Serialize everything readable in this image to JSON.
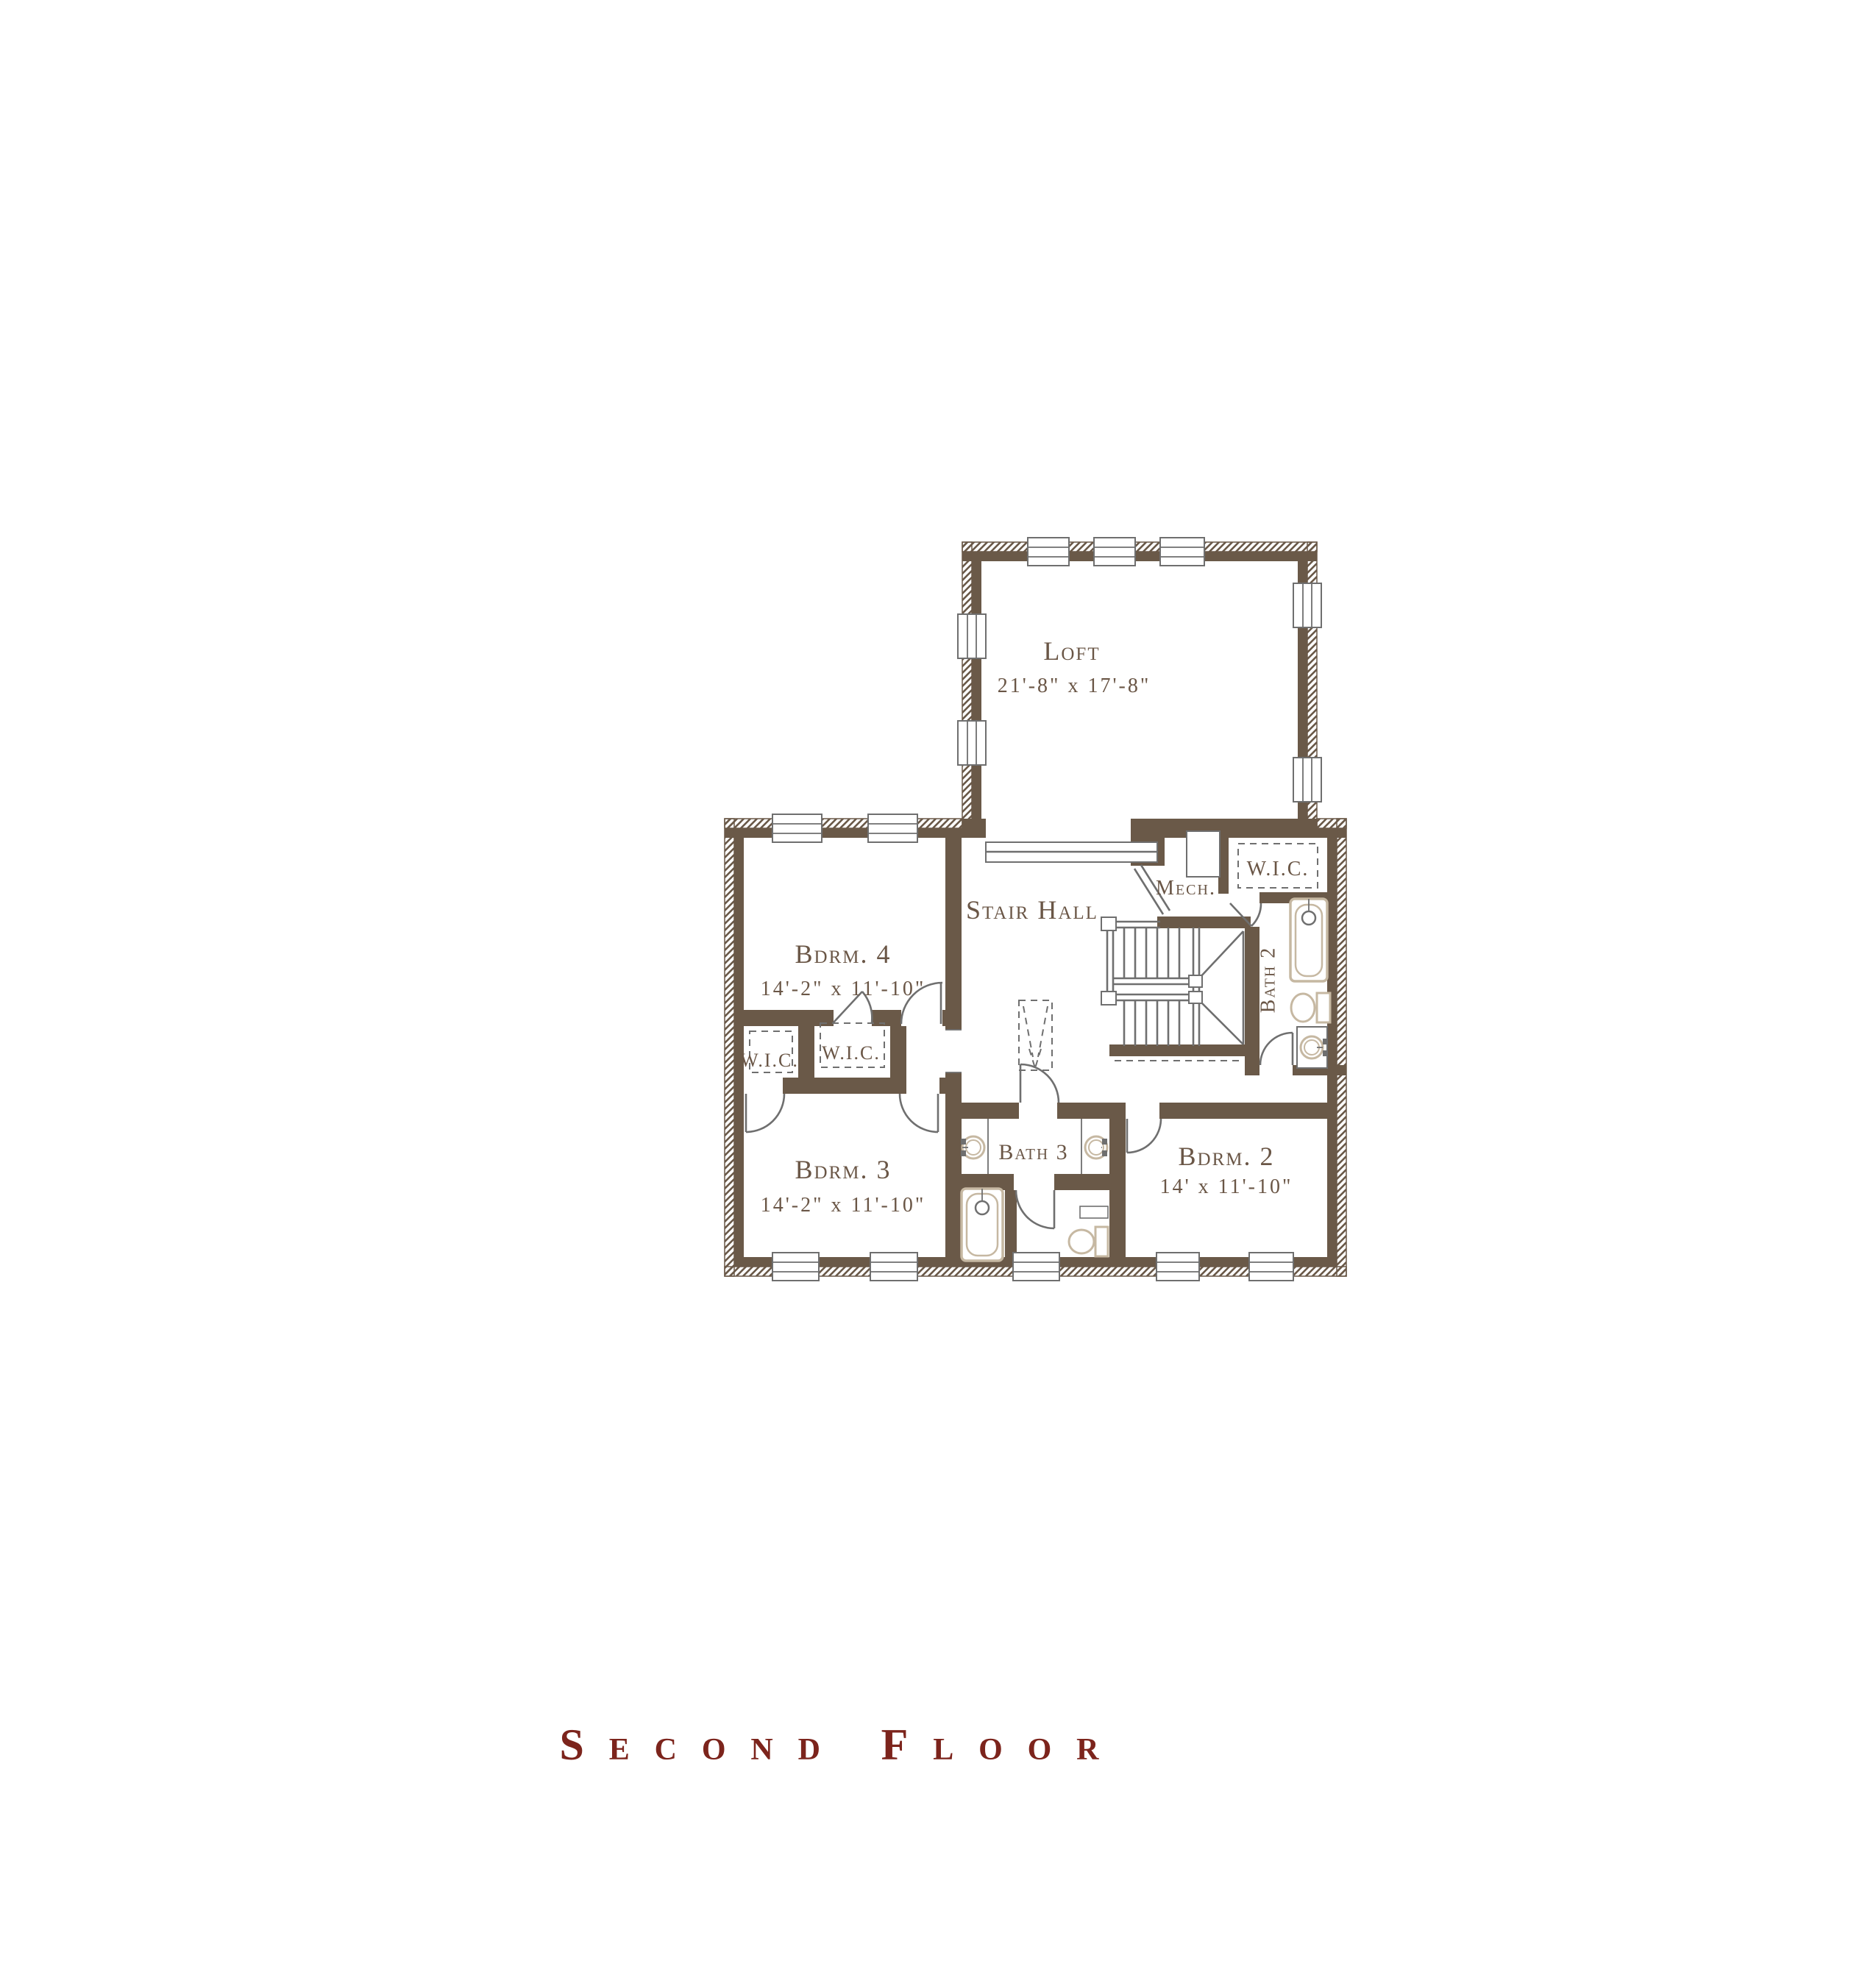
{
  "plan_title": "Second Floor",
  "colors": {
    "wall": "#6a5948",
    "line": "#6f6f6f",
    "fixture": "#c6b8a2",
    "text": "#6a5646",
    "title": "#7c241c"
  },
  "rooms": [
    {
      "id": "loft",
      "label": "Loft",
      "dims": "21'-8\" x 17'-8\""
    },
    {
      "id": "bdrm4",
      "label": "Bdrm. 4",
      "dims": "14'-2\" x 11'-10\""
    },
    {
      "id": "stair-hall",
      "label": "Stair Hall",
      "dims": ""
    },
    {
      "id": "mech",
      "label": "Mech.",
      "dims": ""
    },
    {
      "id": "wic-upper",
      "label": "W.I.C.",
      "dims": ""
    },
    {
      "id": "bath2",
      "label": "Bath 2",
      "dims": ""
    },
    {
      "id": "wic-left",
      "label": "W.I.C.",
      "dims": ""
    },
    {
      "id": "wic-mid",
      "label": "W.I.C.",
      "dims": ""
    },
    {
      "id": "bdrm3",
      "label": "Bdrm. 3",
      "dims": "14'-2\" x 11'-10\""
    },
    {
      "id": "bath3",
      "label": "Bath 3",
      "dims": ""
    },
    {
      "id": "bdrm2",
      "label": "Bdrm. 2",
      "dims": "14' x 11'-10\""
    }
  ],
  "fixtures": [
    "bathtub",
    "toilet",
    "sink",
    "staircase",
    "railing",
    "attic-access",
    "closet-shelving",
    "mechanical-unit",
    "window",
    "door"
  ]
}
